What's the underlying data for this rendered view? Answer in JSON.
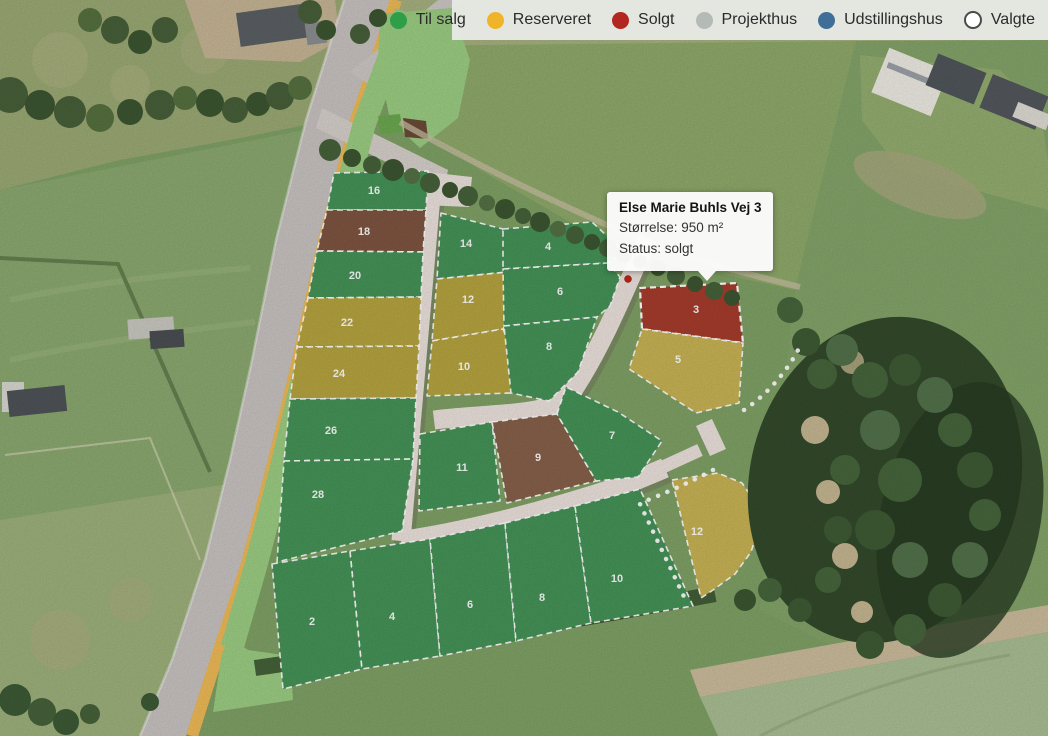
{
  "legend": {
    "items": [
      {
        "label": "Til salg",
        "color": "#2f9e48",
        "type": "dot"
      },
      {
        "label": "Reserveret",
        "color": "#f0b429",
        "type": "dot"
      },
      {
        "label": "Solgt",
        "color": "#b2271f",
        "type": "dot"
      },
      {
        "label": "Projekthus",
        "color": "#b4bab6",
        "type": "dot"
      },
      {
        "label": "Udstillingshus",
        "color": "#3f6f98",
        "type": "dot"
      },
      {
        "label": "Valgte",
        "color": "#ffffff",
        "type": "outline"
      }
    ]
  },
  "tooltip": {
    "title": "Else Marie Buhls Vej 3",
    "size_line": "Størrelse: 950 m²",
    "status_line": "Status: solgt"
  },
  "status_colors": {
    "til_salg": "#459257",
    "reserveret": "#b5a33f",
    "reserveret_light": "#c7b254",
    "solgt": "#a53c2c",
    "solgt_brown": "#7e5440",
    "solgt_brown_light": "#86604a"
  },
  "plots": [
    {
      "number": "16",
      "status": "Til salg",
      "fill": "til_salg"
    },
    {
      "number": "18",
      "status": "Solgt",
      "fill": "solgt_brown"
    },
    {
      "number": "20",
      "status": "Til salg",
      "fill": "til_salg"
    },
    {
      "number": "22",
      "status": "Reserveret",
      "fill": "reserveret"
    },
    {
      "number": "24",
      "status": "Reserveret",
      "fill": "reserveret"
    },
    {
      "number": "26",
      "status": "Til salg",
      "fill": "til_salg"
    },
    {
      "number": "28",
      "status": "Til salg",
      "fill": "til_salg"
    },
    {
      "number": "14",
      "status": "Til salg",
      "fill": "til_salg"
    },
    {
      "number": "12",
      "status": "Reserveret",
      "fill": "reserveret"
    },
    {
      "number": "10",
      "status": "Reserveret",
      "fill": "reserveret"
    },
    {
      "number": "11",
      "status": "Til salg",
      "fill": "til_salg"
    },
    {
      "number": "4",
      "status": "Til salg",
      "fill": "til_salg"
    },
    {
      "number": "6",
      "status": "Til salg",
      "fill": "til_salg"
    },
    {
      "number": "8",
      "status": "Til salg",
      "fill": "til_salg"
    },
    {
      "number": "9",
      "status": "Solgt",
      "fill": "solgt_brown_light"
    },
    {
      "number": "7",
      "status": "Til salg",
      "fill": "til_salg"
    },
    {
      "number": "3",
      "status": "Solgt",
      "fill": "solgt",
      "selected": true
    },
    {
      "number": "5",
      "status": "Reserveret",
      "fill": "reserveret_light"
    },
    {
      "number": "12",
      "status": "Reserveret",
      "fill": "reserveret_light"
    },
    {
      "number": "2",
      "status": "Til salg",
      "fill": "til_salg"
    },
    {
      "number": "4",
      "status": "Til salg",
      "fill": "til_salg"
    },
    {
      "number": "6",
      "status": "Til salg",
      "fill": "til_salg"
    },
    {
      "number": "8",
      "status": "Til salg",
      "fill": "til_salg"
    },
    {
      "number": "10",
      "status": "Til salg",
      "fill": "til_salg"
    }
  ]
}
